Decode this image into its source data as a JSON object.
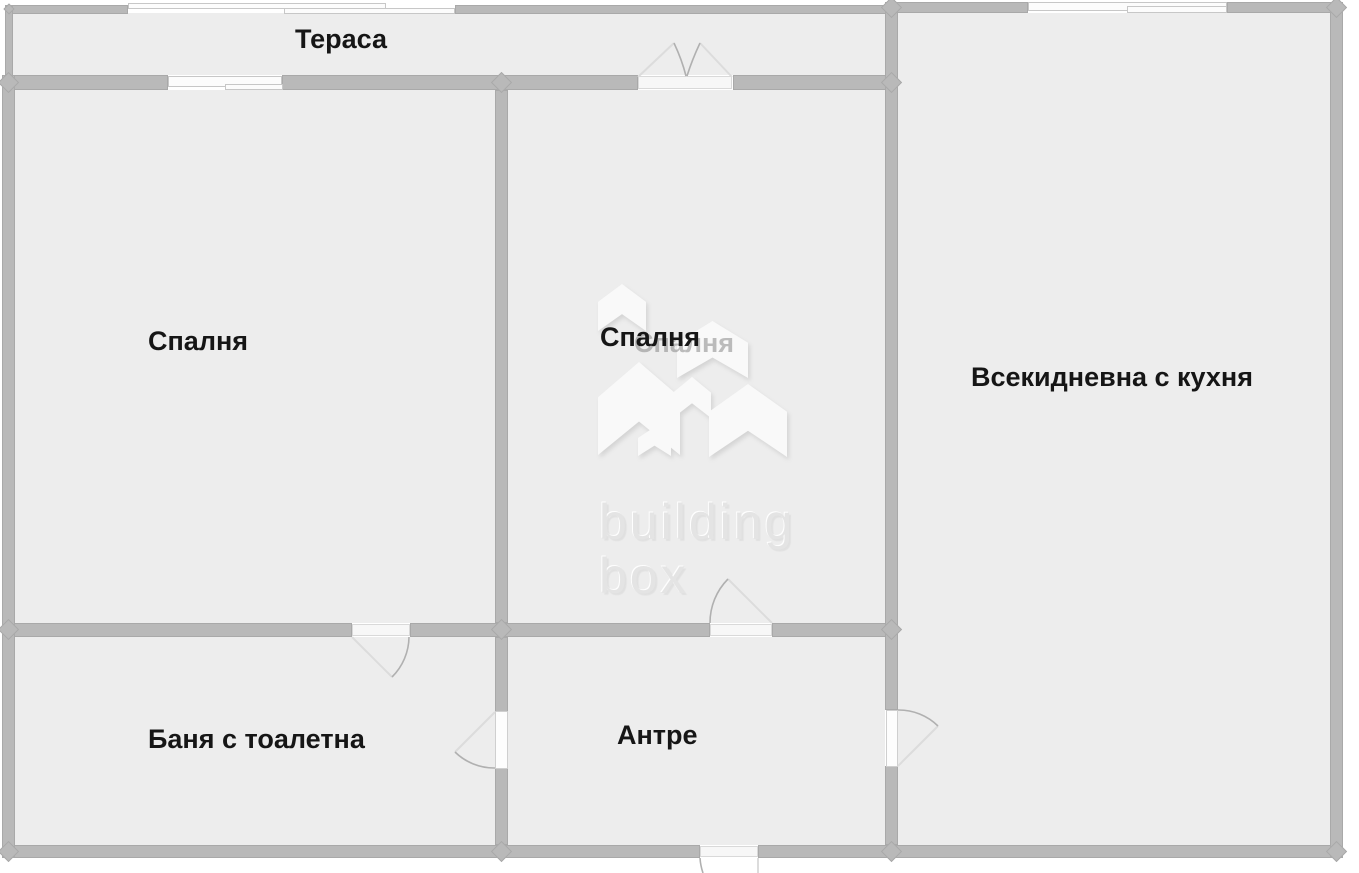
{
  "plan": {
    "title": "apartment-floor-plan",
    "rooms": [
      {
        "id": "terrace",
        "label": "Тераса"
      },
      {
        "id": "bedroom-left",
        "label": "Спалня"
      },
      {
        "id": "bedroom-middle",
        "label": "Спалня"
      },
      {
        "id": "living-kitchen",
        "label": "Всекидневна с кухня"
      },
      {
        "id": "bathroom",
        "label": "Баня с тоалетна"
      },
      {
        "id": "hallway",
        "label": "Антре"
      }
    ],
    "watermark": {
      "line1": "building",
      "line2": "box"
    },
    "colors": {
      "floor": "#ededed",
      "wall": "#b9b9b9",
      "wall_edge": "#a9a9a9",
      "window": "#fcfcfc",
      "door_arc": "#b0b0b0",
      "door_leaf": "#dcdcdc",
      "label_text": "#161616",
      "watermark_shape": "#f9f9f9",
      "watermark_text": "#e4e4e4",
      "background": "#ffffff"
    }
  }
}
